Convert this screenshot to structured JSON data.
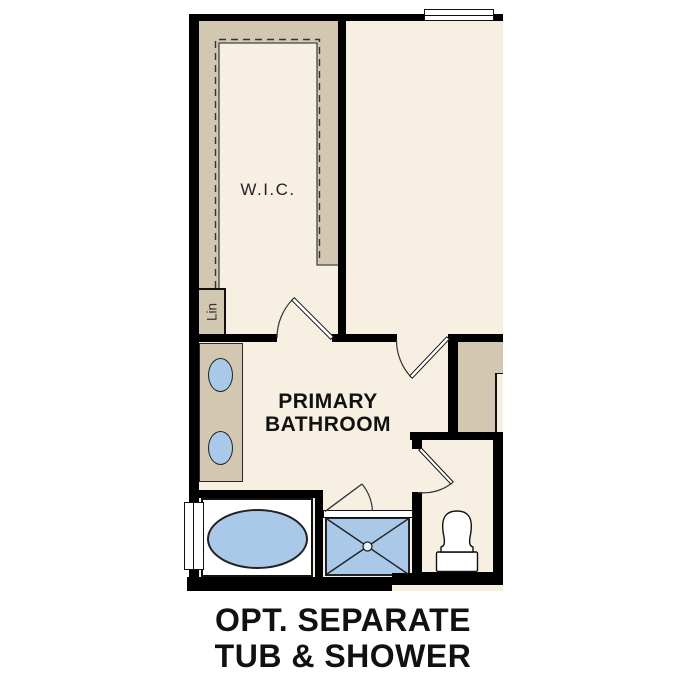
{
  "caption": {
    "line1": "OPT. SEPARATE",
    "line2": "TUB & SHOWER"
  },
  "labels": {
    "wic": "W.I.C.",
    "linen": "Lin",
    "bathroom_line1": "PRIMARY",
    "bathroom_line2": "BATHROOM"
  },
  "colors": {
    "wall": "#000000",
    "floor": "#f7efe2",
    "casework": "#d2c8b2",
    "fixture_fill": "#aac9e8",
    "fixture_outline": "#222222",
    "glass_white": "#ffffff",
    "text_dark": "#111111",
    "label_muted": "#222222"
  }
}
